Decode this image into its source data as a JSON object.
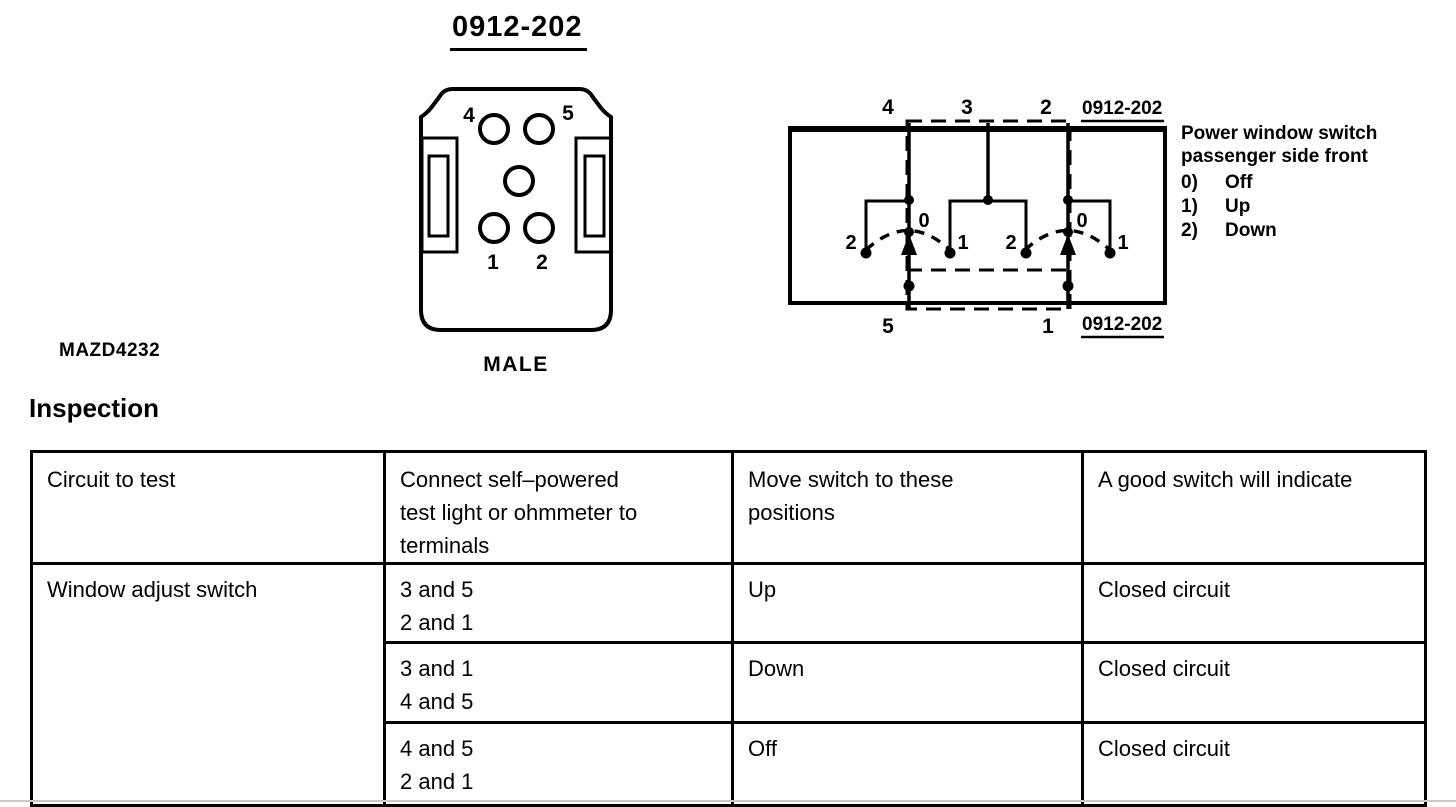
{
  "page": {
    "title": "0912-202",
    "figure_code": "MAZD4232",
    "connector_gender": "MALE",
    "section_heading": "Inspection"
  },
  "connector": {
    "pin_top_left": "4",
    "pin_top_right": "5",
    "pin_bottom_left": "1",
    "pin_bottom_right": "2"
  },
  "circuit": {
    "ref_top": "0912-202",
    "ref_bottom": "0912-202",
    "terminal_top_left": "4",
    "terminal_top_center": "3",
    "terminal_top_right": "2",
    "terminal_bottom_left": "5",
    "terminal_bottom_right": "1",
    "left_switch": {
      "left_pos": "2",
      "center_pos": "0",
      "right_pos": "1"
    },
    "right_switch": {
      "left_pos": "2",
      "center_pos": "0",
      "right_pos": "1"
    },
    "legend": {
      "line1": "Power window switch",
      "line2": "passenger side front",
      "items": [
        {
          "num": "0)",
          "label": "Off"
        },
        {
          "num": "1)",
          "label": "Up"
        },
        {
          "num": "2)",
          "label": "Down"
        }
      ]
    }
  },
  "table": {
    "headers": [
      {
        "lines": [
          "Circuit to test"
        ]
      },
      {
        "lines": [
          "Connect self–powered",
          "test light or ohmmeter to",
          "terminals"
        ]
      },
      {
        "lines": [
          "Move switch to these",
          "positions"
        ]
      },
      {
        "lines": [
          "A good switch will indicate"
        ]
      }
    ],
    "row_group_label": "Window adjust switch",
    "rows": [
      {
        "terminals": [
          "3 and 5",
          "2 and 1"
        ],
        "position": "Up",
        "result": "Closed circuit"
      },
      {
        "terminals": [
          "3 and 1",
          "4 and 5"
        ],
        "position": "Down",
        "result": "Closed circuit"
      },
      {
        "terminals": [
          "4 and 5",
          "2 and 1"
        ],
        "position": "Off",
        "result": "Closed circuit"
      }
    ]
  }
}
